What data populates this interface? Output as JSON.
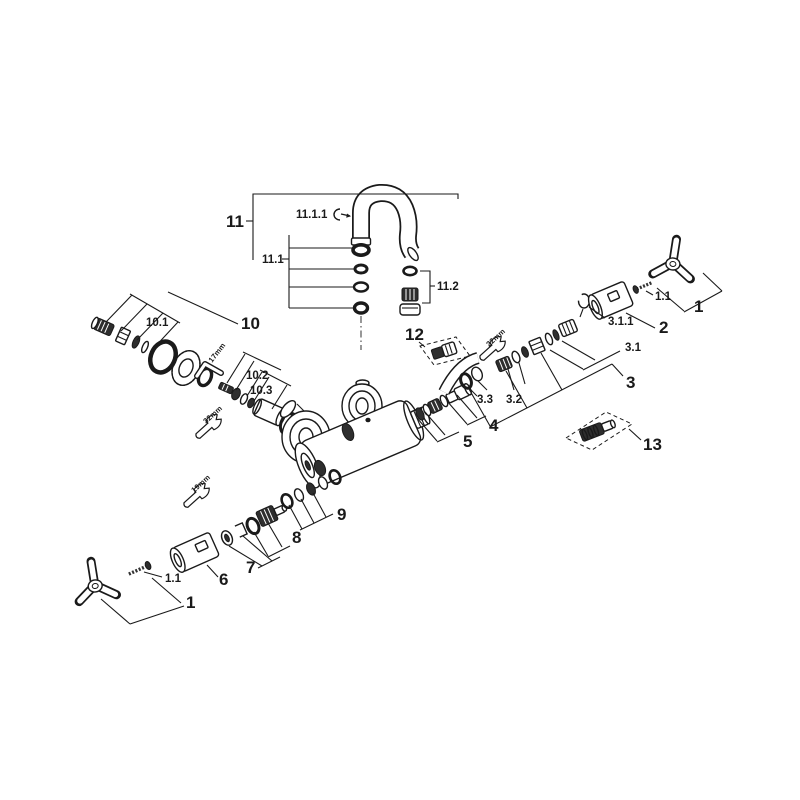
{
  "diagram": {
    "kind": "exploded-parts-diagram",
    "background_color": "#ffffff",
    "line_color": "#1a1a1a"
  },
  "labels": {
    "n11": "11",
    "n11_1": "11.1",
    "n11_1_1": "11.1.1",
    "n11_2": "11.2",
    "n10": "10",
    "n10_1": "10.1",
    "n10_2": "10.2",
    "n10_3": "10.3",
    "n12": "12",
    "n13": "13",
    "n1_top_right": "1",
    "n1_1_top_right": "1.1",
    "n2": "2",
    "n3": "3",
    "n3_1": "3.1",
    "n3_1_1": "3.1.1",
    "n3_2": "3.2",
    "n3_3": "3.3",
    "n4": "4",
    "n5": "5",
    "n6": "6",
    "n7": "7",
    "n8": "8",
    "n9": "9",
    "n1_bottom_left": "1",
    "n1_1_bottom_left": "1.1"
  },
  "tools": {
    "allen_key": "17mm",
    "wrench_spout": "32mm",
    "wrench_cartridge": "19mm",
    "wrench_union": "22mm"
  }
}
